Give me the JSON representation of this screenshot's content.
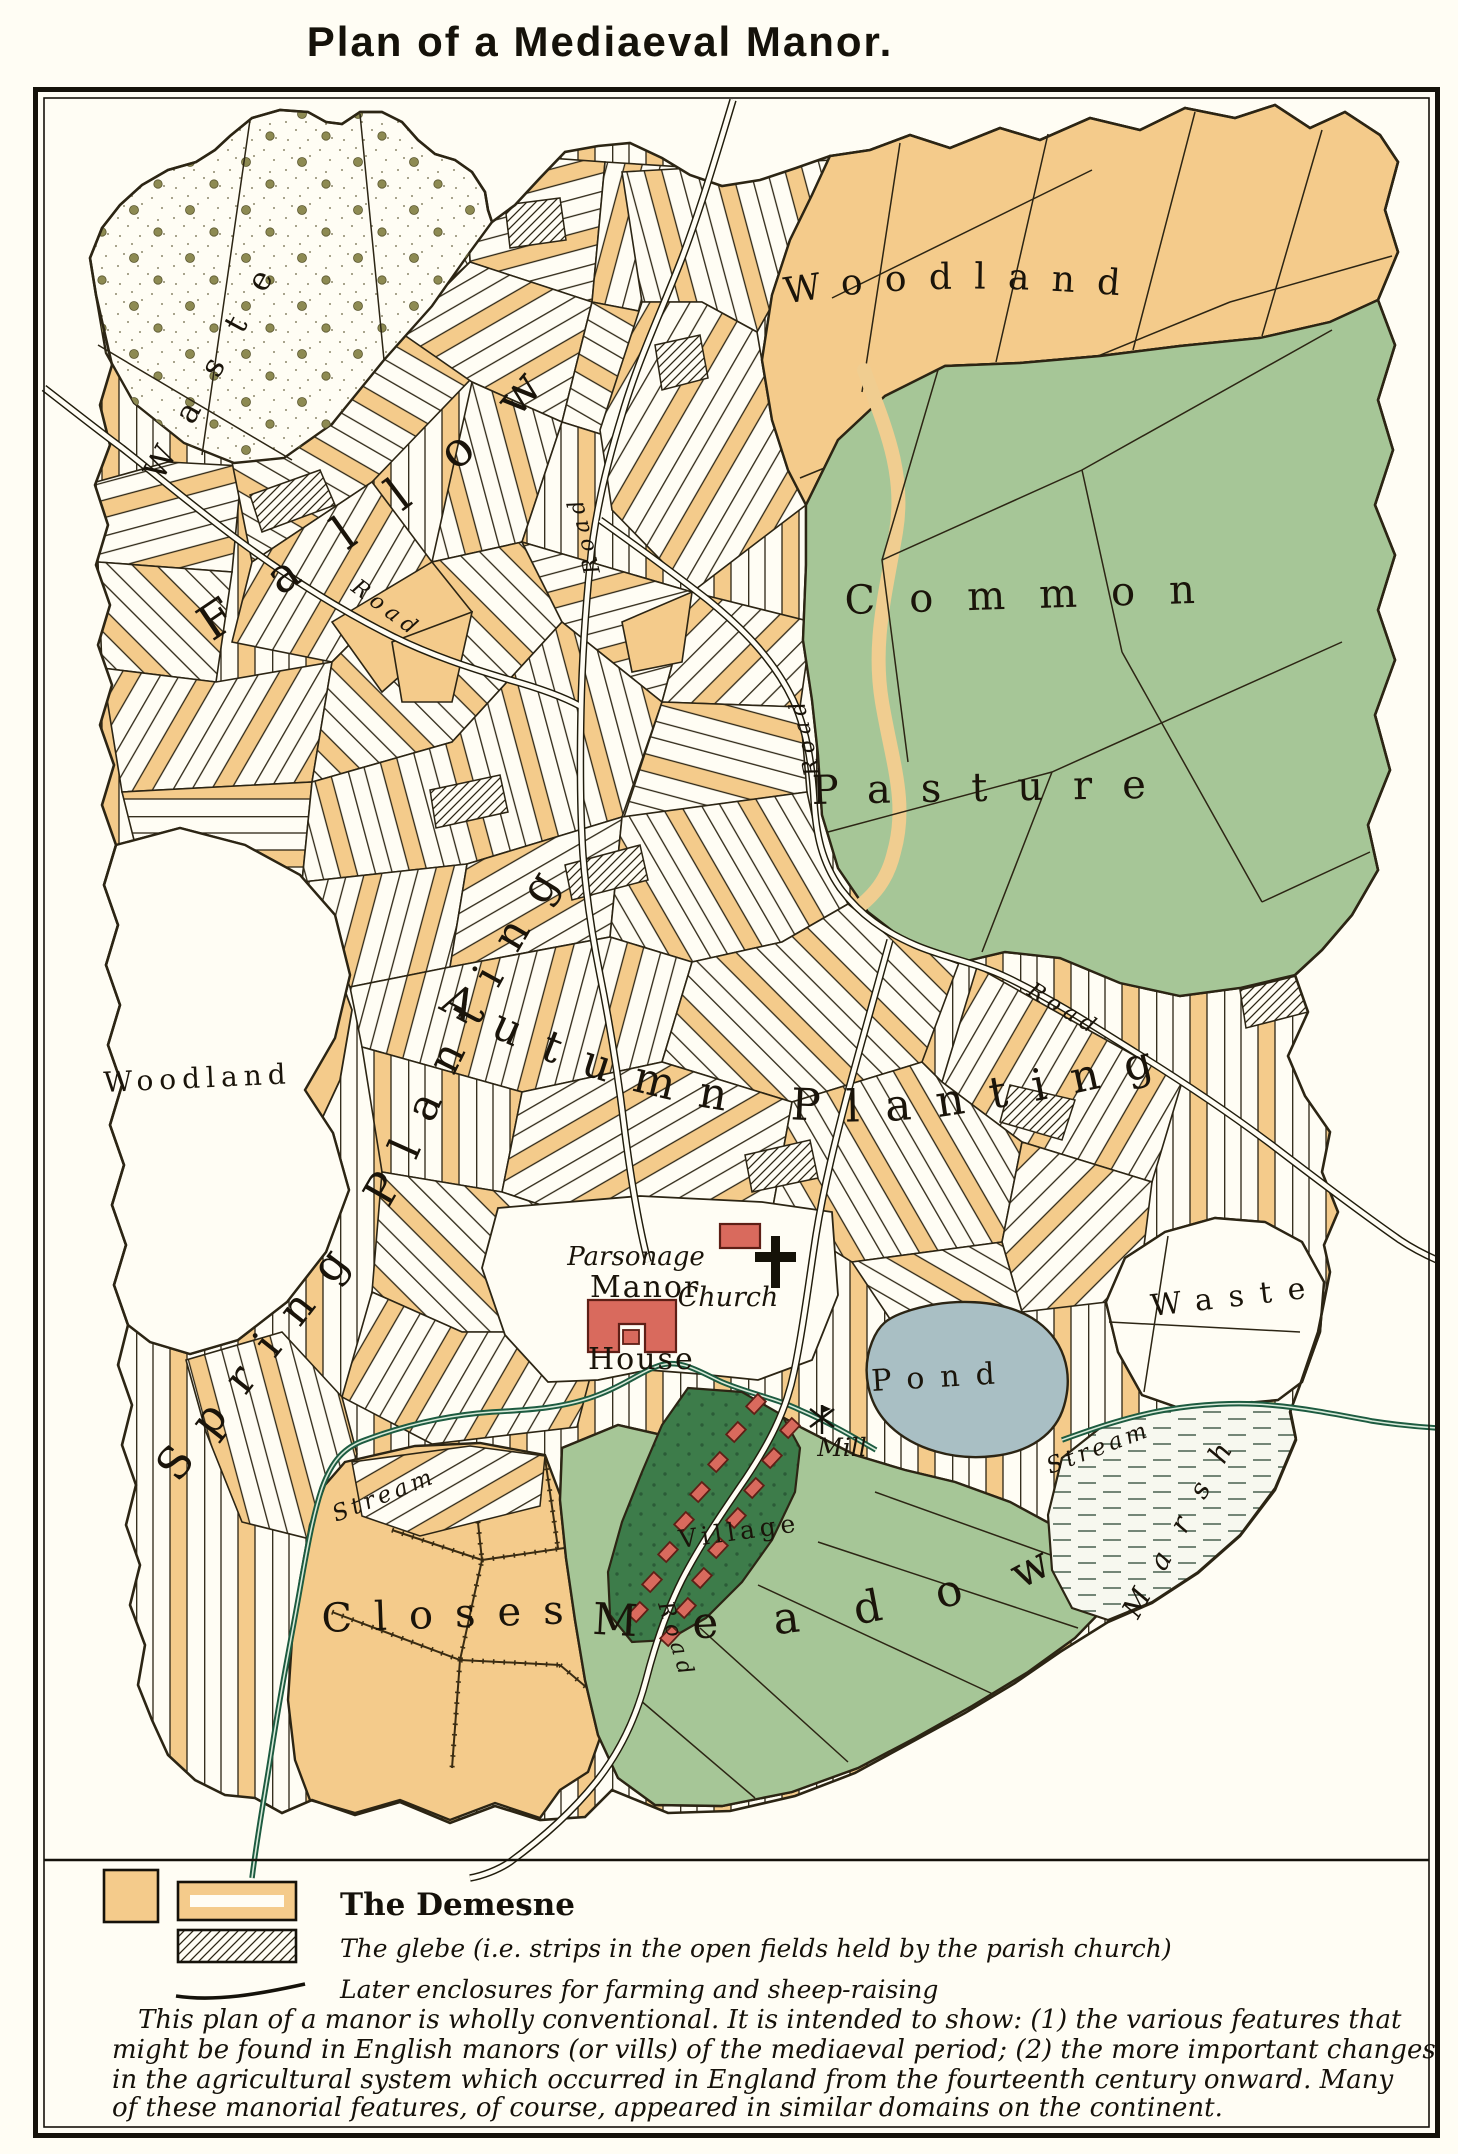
{
  "title": "Plan of a Mediaeval Manor.",
  "map": {
    "labels": [
      {
        "name": "label-waste-nw",
        "text": "Waste"
      },
      {
        "name": "label-fallow",
        "text": "Fallow"
      },
      {
        "name": "label-woodland-ne",
        "text": "Woodland"
      },
      {
        "name": "label-common",
        "text": "Common"
      },
      {
        "name": "label-pasture",
        "text": "Pasture"
      },
      {
        "name": "label-autumn-planting",
        "text": "Autumn Planting"
      },
      {
        "name": "label-spring-planting",
        "text": "Spring Planting"
      },
      {
        "name": "label-woodland-w",
        "text": "Woodland"
      },
      {
        "name": "label-waste-e",
        "text": "Waste"
      },
      {
        "name": "label-closes",
        "text": "Closes"
      },
      {
        "name": "label-meadow",
        "text": "Meadow"
      },
      {
        "name": "label-village",
        "text": "Village"
      },
      {
        "name": "label-pond",
        "text": "Pond"
      },
      {
        "name": "label-marsh",
        "text": "Marsh"
      },
      {
        "name": "label-mill",
        "text": "Mill"
      },
      {
        "name": "label-church",
        "text": "Church"
      },
      {
        "name": "label-parsonage",
        "text": "Parsonage"
      },
      {
        "name": "label-manor",
        "text": "Manor"
      },
      {
        "name": "label-house",
        "text": "House"
      },
      {
        "name": "label-road-1",
        "text": "Road"
      },
      {
        "name": "label-road-2",
        "text": "Road"
      },
      {
        "name": "label-road-3",
        "text": "Road"
      },
      {
        "name": "label-road-4",
        "text": "Road"
      },
      {
        "name": "label-road-5",
        "text": "Road"
      },
      {
        "name": "label-stream-1",
        "text": "Stream"
      },
      {
        "name": "label-stream-2",
        "text": "Stream"
      }
    ],
    "icons": [
      "mill-windmill-icon",
      "church-cross-icon"
    ]
  },
  "legend": {
    "demesne_label": "The Demesne",
    "glebe_label": "The glebe (i.e. strips in the open fields held by the parish church)",
    "enclosures_label": "Later enclosures for farming and sheep-raising"
  },
  "caption_lines": [
    "This plan of a manor is wholly conventional.  It is intended to show:  (1) the various features that",
    "might be found in English manors (or vills) of the mediaeval period;  (2) the more important changes",
    "in the agricultural system which occurred in England from the fourteenth century onward. Many",
    "of these manorial features, of course, appeared in similar domains on the continent."
  ],
  "colors": {
    "paper": "#fffdf4",
    "demesne_orange": "#f4cb8b",
    "pasture_green": "#a6c697",
    "village_green": "#3d7c4a",
    "pond_blue": "#a9bfc4",
    "building_red": "#d96a5d",
    "stream_green": "#1d5b40",
    "ink": "#2c2514"
  }
}
